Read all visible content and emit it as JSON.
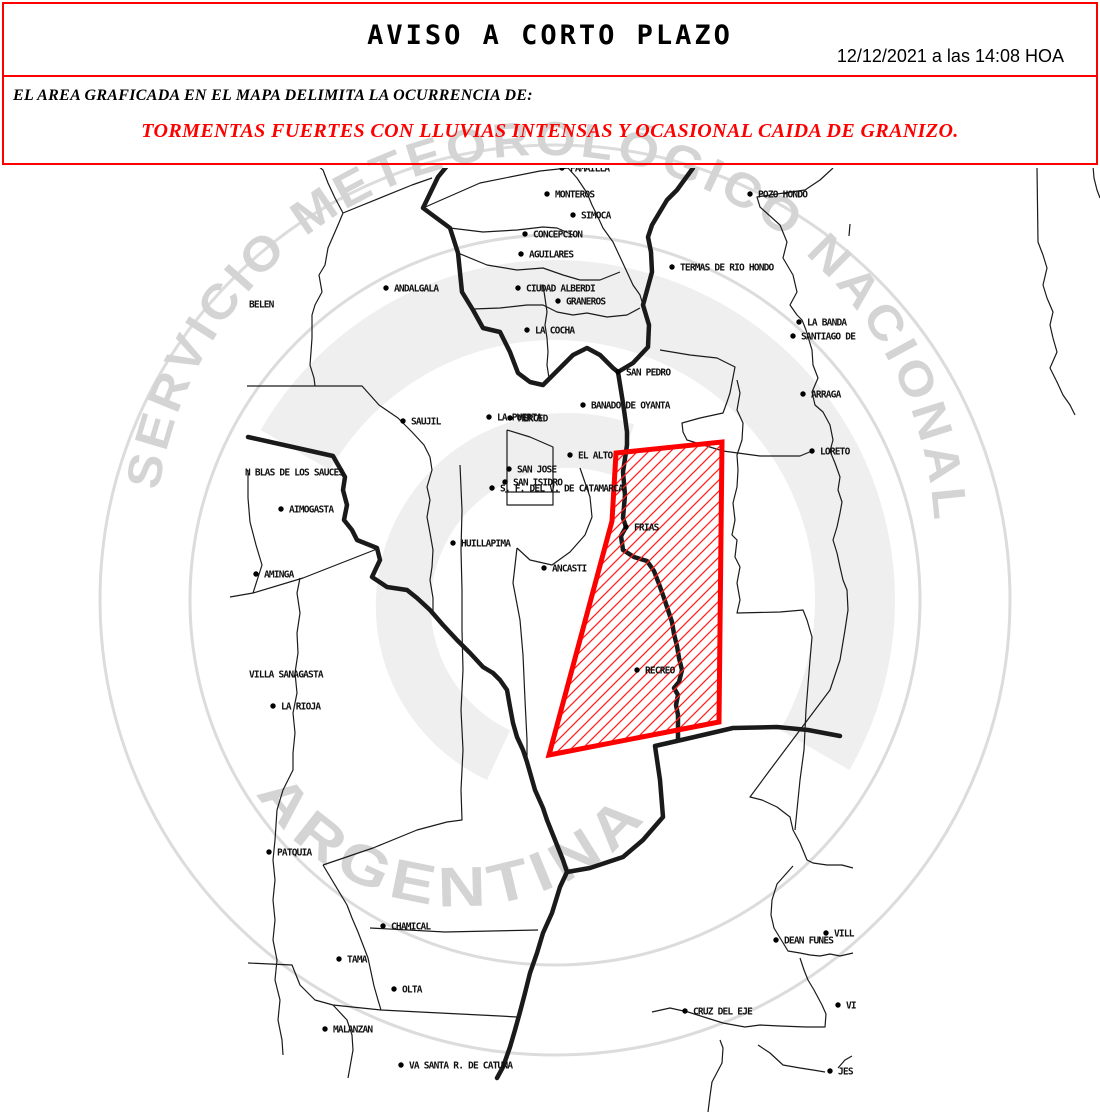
{
  "header": {
    "title": "AVISO A CORTO PLAZO",
    "datetime": "12/12/2021 a las 14:08 HOA",
    "line1": "EL AREA GRAFICADA EN EL MAPA DELIMITA LA OCURRENCIA DE:",
    "line2": "TORMENTAS FUERTES CON LLUVIAS INTENSAS Y OCASIONAL CAIDA DE GRANIZO.",
    "border_color": "#ff0000",
    "alert_text_color": "#ff0000"
  },
  "watermark": {
    "text_top": "SERVICIO METEOROLÓGICO NACIONAL",
    "text_bottom": "ARGENTINA",
    "text_color": "#d4d4d4",
    "ring_color": "#dcdcdc",
    "swirl_color": "#efefef"
  },
  "map": {
    "ink": "#1a1a1a",
    "label_color": "#111111",
    "alert_polygon": {
      "stroke": "#ff0000",
      "hatch_color": "#ff2020",
      "points": "616,453 612,521 549,755 719,722 722,442"
    },
    "thick_borders": [
      "M447,166 L438,177 L423,208 L450,228 L458,253 L462,292 L473,310 L483,328 L500,332 L510,352 L518,373 L530,382 L543,385 L563,365 L573,355 L587,348 L600,355 L613,368 L618,372",
      "M618,372 L633,363 L648,347 L649,325 L643,305 L652,272 L651,252 L648,237 L652,225 L667,200 L677,190 L693,168",
      "M618,372 L623,403 L625,417 L627,432 L627,445 L623,472 L625,495 L623,518 L626,527 L621,536 L623,550 L634,557 L647,561 L654,571 L659,584 L664,598 L668,610 L672,622 L674,634 L677,646 L679,658 L682,670 L679,682 L674,688 L678,695 L676,705 L678,715 L678,740",
      "M248,437 L333,456 L345,477 L343,490 L347,505 L344,520 L352,530 L357,540 L377,548 L380,560 L372,577 L387,587 L407,590 L417,598 L430,610 L443,625 L457,640 L470,653 L483,667 L493,673 L500,680 L507,690 L510,707 L513,723 L517,737 L523,750 L527,762 L535,790 L543,808 L547,820 L555,840 L563,860 L567,872",
      "M567,872 L590,868 L623,857 L643,840 L663,817 L660,780 L655,746 L690,738 L733,728 L777,727 L808,730 L840,736",
      "M567,872 L560,887 L552,913 L543,933 L537,953 L530,973 L525,993 L520,1012 L515,1030 L510,1047 L503,1067 L497,1078"
    ],
    "thin_borders": [
      "M318,166 L323,170 L328,183 L335,198 L343,213 L338,225 L328,248 L325,265 L319,275 L322,292 L315,305 L312,315 L312,338 L311,352 L310,365 L314,378 L315,386",
      "M247,386 L362,386 L379,405 L398,418 L412,432 L424,445 L430,457",
      "M343,213 L412,185 L432,178",
      "M423,208 L480,183 L540,171 L568,168",
      "M568,168 L577,178 L587,193 L592,205 L597,215 L603,228 L613,242 L620,257 L627,272 L633,285 L640,295 L643,305",
      "M450,228 L483,232 L517,230 L543,227 L557,228 L573,235",
      "M458,253 L487,265 L517,270 L543,268 L563,275 L580,280 L600,280 L620,272",
      "M473,309 L500,308 L527,305 L543,305 L557,312 L573,315 L587,313 L607,317 L627,315 L640,308",
      "M543,285 L545,298 L547,312 L545,325 L547,338 L548,352 L547,365 L549,378",
      "M833,168 L820,180 L805,190 L770,195 L757,197 L760,207 L780,225 L787,242 L783,258 L793,275 L797,292 L790,305 L797,315 L802,320 L806,330 L812,350 L813,365 L818,378 L812,392 L815,405 L823,412 L830,425 L833,440 L830,451 L835,463 L840,477 L838,490 L842,502 L840,513 L837,527 L833,540 L837,553 L840,567 L843,580 L847,590 L848,610 L845,630 L840,660 L830,690 L800,730 L770,770 L750,797 L762,800 L777,807 L790,817 L793,830 L800,843 L807,860 L813,863 L827,865 L842,865 L853,868",
      "M1037,168 L1038,242 L1043,255 L1047,268 L1043,285 L1047,298 L1053,312 L1050,325 L1053,338 L1057,352 L1050,368 L1057,382 L1063,395 L1070,405 L1075,415",
      "M737,380 L740,393 L737,410 L743,423 L742,440 L737,455 L738,470 L737,487 L733,503 L735,520 L732,535 L737,540 L735,557 L740,567 L737,583 L740,600 L737,613 L780,612 L803,610 L807,620 L812,637 L810,660 L808,685 L806,710 L804,750 L800,780 L797,810 L795,830",
      "M660,350 L690,355 L717,358 L735,367 L730,393 L727,402 L723,413 L700,418 L682,423 L683,432 L687,440 L700,444 L723,451 L760,456 L800,456 L812,451",
      "M793,866 L777,884 L772,900 L771,915 L774,928 L788,951 L800,953 L810,955 L820,956 L830,954 L840,956 L853,953",
      "M800,958 L804,970 L808,980 L814,990 L822,1005 L826,1014 L825,1027 L806,1027 L780,1026 L760,1025 L745,1027 L723,1023 L707,1018 L688,1012 L670,1008 L652,1012",
      "M720,1040 L723,1048 L722,1063 L712,1082 L710,1096 L708,1112",
      "M758,1045 L770,1053 L783,1065 L800,1068 L813,1070 L825,1072",
      "M838,1068 L845,1060 L852,1056",
      "M517,548 L513,583 L520,620 L523,655 L525,700 L527,740 L527,760",
      "M580,468 L590,497 L592,517 L585,535 L570,552 L552,565 L530,560 L517,548",
      "M507,430 L507,505 L553,505 L553,447 L530,437 L507,430",
      "M505,492 L560,492",
      "M460,465 L462,510 L461,550 L462,590 L462,630 L463,670 L461,710 L463,750 L461,790 L462,820 L447,822 L417,830 L373,848 L323,865",
      "M323,865 L347,905 L352,918 L358,932 L363,945 L368,958 L371,972 L374,986 L378,1000 L381,1010 L420,1012 L460,1014 L500,1016 L517,1017",
      "M370,928 L445,932 L538,930",
      "M248,963 L292,965 L300,985 L315,1000 L333,1005 L381,1010",
      "M333,1005 L347,1020 L352,1035 L353,1050 L350,1067 L348,1078",
      "M230,597 L253,593 L303,578 L377,549",
      "M300,578 L297,593 L300,613 L297,633 L298,653 L295,673 L297,693 L293,713 L295,733 L293,753 L293,770 L283,790 L277,810 L275,840 L273,860 L275,880 L273,900 L275,920 L273,940 L277,960 L275,980 L280,1000 L278,1020 L282,1040 L283,1055",
      "M248,470 L248,498 L250,522 L256,545 L262,565 L253,593",
      "M430,457 L432,470 L427,487 L430,500 L427,517 L430,533 L433,550 L432,567 L430,580 L433,598 L433,612",
      "M850,224 L849,236",
      "M1093,166 L1094,178 L1097,190 L1100,198"
    ],
    "labels": [
      {
        "text": "FAMAILLA",
        "x": 562,
        "y": 168,
        "dot": true
      },
      {
        "text": "MONTEROS",
        "x": 547,
        "y": 194,
        "dot": true
      },
      {
        "text": "SIMOCA",
        "x": 573,
        "y": 215,
        "dot": true
      },
      {
        "text": "CONCEPCION",
        "x": 525,
        "y": 234,
        "dot": true
      },
      {
        "text": "AGUILARES",
        "x": 521,
        "y": 254,
        "dot": true
      },
      {
        "text": "CIUDAD ALBERDI",
        "x": 518,
        "y": 288,
        "dot": true
      },
      {
        "text": "GRANEROS",
        "x": 558,
        "y": 301,
        "dot": true
      },
      {
        "text": "LA COCHA",
        "x": 527,
        "y": 330,
        "dot": true
      },
      {
        "text": "SAN PEDRO",
        "x": 618,
        "y": 372,
        "dot": true
      },
      {
        "text": "POZO HONDO",
        "x": 750,
        "y": 194,
        "dot": true
      },
      {
        "text": "TERMAS DE RIO HONDO",
        "x": 672,
        "y": 267,
        "dot": true
      },
      {
        "text": "LA BANDA",
        "x": 799,
        "y": 322,
        "dot": true
      },
      {
        "text": "SANTIAGO DE",
        "x": 793,
        "y": 336,
        "dot": true
      },
      {
        "text": "ARRAGA",
        "x": 803,
        "y": 394,
        "dot": true
      },
      {
        "text": "LORETO",
        "x": 812,
        "y": 451,
        "dot": true
      },
      {
        "text": "BELEN",
        "x": 247,
        "y": 304,
        "dot": false
      },
      {
        "text": "ANDALGALA",
        "x": 386,
        "y": 288,
        "dot": true
      },
      {
        "text": "SAUJIL",
        "x": 403,
        "y": 421,
        "dot": true
      },
      {
        "text": "LA PUERTA",
        "x": 489,
        "y": 417,
        "dot": true
      },
      {
        "text": "MERCED",
        "x": 510,
        "y": 418,
        "dot": true
      },
      {
        "text": "BANADO DE OYANTA",
        "x": 583,
        "y": 405,
        "dot": true
      },
      {
        "text": "EL ALTO",
        "x": 570,
        "y": 455,
        "dot": true
      },
      {
        "text": "SAN JOSE",
        "x": 509,
        "y": 469,
        "dot": true
      },
      {
        "text": "SAN ISIDRO",
        "x": 505,
        "y": 482,
        "dot": true
      },
      {
        "text": "S. F. DEL V. DE CATAMARCA",
        "x": 492,
        "y": 488,
        "dot": true
      },
      {
        "text": "N BLAS DE LOS SAUCES",
        "x": 243,
        "y": 472,
        "dot": false
      },
      {
        "text": "AIMOGASTA",
        "x": 281,
        "y": 509,
        "dot": true
      },
      {
        "text": "HUILLAPIMA",
        "x": 453,
        "y": 543,
        "dot": true
      },
      {
        "text": "AMINGA",
        "x": 256,
        "y": 574,
        "dot": true
      },
      {
        "text": "ANCASTI",
        "x": 544,
        "y": 568,
        "dot": true
      },
      {
        "text": "FRIAS",
        "x": 626,
        "y": 527,
        "dot": true
      },
      {
        "text": "RECREO",
        "x": 637,
        "y": 670,
        "dot": true
      },
      {
        "text": "VILLA SANAGASTA",
        "x": 247,
        "y": 674,
        "dot": false
      },
      {
        "text": "LA RIOJA",
        "x": 273,
        "y": 706,
        "dot": true
      },
      {
        "text": "PATQUIA",
        "x": 269,
        "y": 852,
        "dot": true
      },
      {
        "text": "CHAMICAL",
        "x": 383,
        "y": 926,
        "dot": true
      },
      {
        "text": "TAMA",
        "x": 339,
        "y": 959,
        "dot": true
      },
      {
        "text": "OLTA",
        "x": 394,
        "y": 989,
        "dot": true
      },
      {
        "text": "MALANZAN",
        "x": 325,
        "y": 1029,
        "dot": true
      },
      {
        "text": "VA SANTA R. DE CATUNA",
        "x": 401,
        "y": 1065,
        "dot": true
      },
      {
        "text": "DEAN FUNES",
        "x": 776,
        "y": 940,
        "dot": true
      },
      {
        "text": "VILL",
        "x": 826,
        "y": 933,
        "dot": true
      },
      {
        "text": "CRUZ DEL EJE",
        "x": 685,
        "y": 1011,
        "dot": true
      },
      {
        "text": "VI",
        "x": 838,
        "y": 1005,
        "dot": true
      },
      {
        "text": "JES",
        "x": 830,
        "y": 1071,
        "dot": true
      }
    ]
  }
}
